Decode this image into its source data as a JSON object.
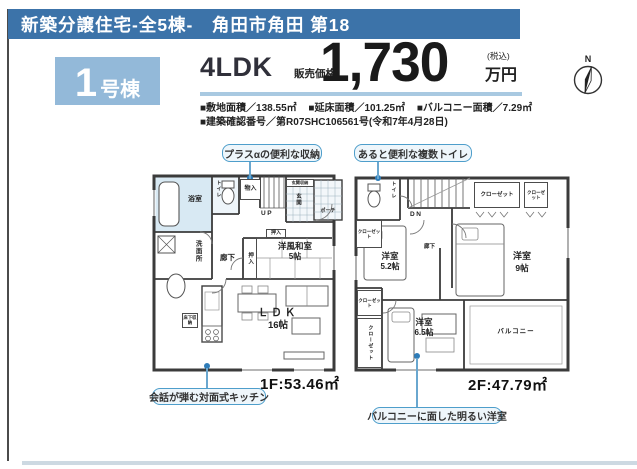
{
  "header": {
    "banner": "新築分譲住宅-全5棟-　角田市角田 第18",
    "badge": {
      "number": "1",
      "suffix": "号棟"
    },
    "layout": "4LDK",
    "price": {
      "label": "販売価格",
      "amount": "1,730",
      "tax": "(税込)",
      "unit": "万円"
    },
    "specs": {
      "line1": [
        "■敷地面積／138.55㎡",
        "■延床面積／101.25㎡",
        "■バルコニー面積／7.29㎡"
      ],
      "line2": "■建築確認番号／第R07SHC106561号(令和7年4月28日)"
    },
    "compass": "N"
  },
  "callouts": {
    "storage": "プラスαの便利な収納",
    "toilet": "あると便利な複数トイレ",
    "kitchen": "会話が弾む対面式キッチン",
    "bright_room": "バルコニーに面した明るい洋室"
  },
  "floor1": {
    "area": "1F:53.46㎡",
    "bath": "浴室",
    "washroom": "洗面所",
    "toilet": "トイレ",
    "storage": "物入",
    "stairs_up": "UP",
    "entrance_storage": "玄関収納",
    "entrance": "玄関",
    "porch": "ポーチ",
    "hall": "廊下",
    "closet_small": "押入",
    "closet": "押入",
    "washitsu": "洋風和室",
    "washitsu_size": "5帖",
    "ldk": "ＬＤＫ",
    "ldk_size": "16帖",
    "floor_storage": "床下収納"
  },
  "floor2": {
    "area": "2F:47.79㎡",
    "toilet": "トイレ",
    "stairs_down": "DN",
    "closet_left_top": "クローゼット",
    "closet_top": "クローゼット",
    "closet_corner": "クローゼット",
    "closet_left_small": "クローゼット",
    "closet_left_tall": "クローゼット",
    "hall": "廊下",
    "room_a": "洋室",
    "room_a_size": "5.2帖",
    "room_b": "洋室",
    "room_b_size": "9帖",
    "room_c": "洋室",
    "room_c_size": "6.5帖",
    "balcony": "バルコニー"
  },
  "colors": {
    "banner_bg": "#3c73a9",
    "badge_bg": "#93b9d9",
    "underline": "#a9c9e1",
    "callout_border": "#4e9ecb",
    "callout_bg": "#eef6fb",
    "connector_dot": "#2e7cb8",
    "bottom_bar": "#cdd9e2",
    "bath_fill": "#d8e9f3"
  }
}
